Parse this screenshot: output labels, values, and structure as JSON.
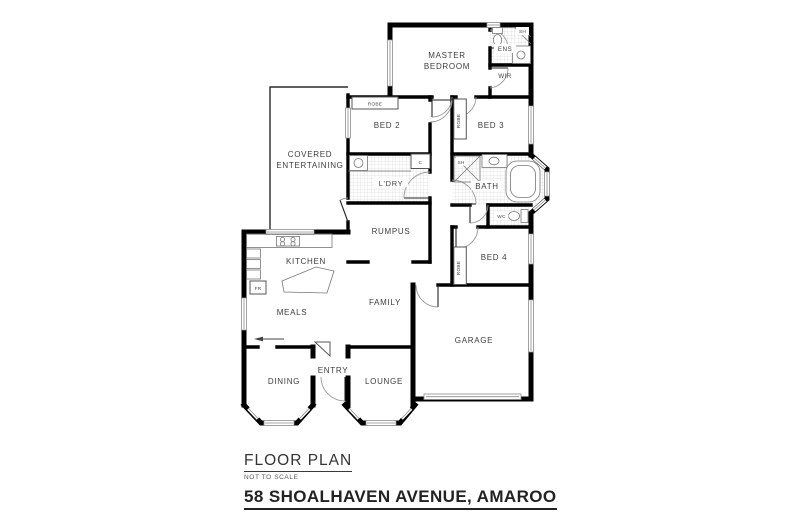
{
  "title_block": {
    "heading": "FLOOR PLAN",
    "note": "NOT TO SCALE",
    "address": "58 SHOALHAVEN AVENUE, AMAROO"
  },
  "colors": {
    "wall": "#000000",
    "label": "#3d3d3d",
    "tile_line": "#cfcfcf",
    "background": "#ffffff"
  },
  "rooms": {
    "master_line1": "MASTER",
    "master_line2": "BEDROOM",
    "ens": "ENS",
    "ens_shower": "SH",
    "wir": "WIR",
    "bed2": "BED 2",
    "bed2_robe": "ROBE",
    "bed3": "BED 3",
    "bed3_robe": "ROBE",
    "covered_line1": "COVERED",
    "covered_line2": "ENTERTAINING",
    "laundry": "L'DRY",
    "laundry_cupboard": "C",
    "bath": "BATH",
    "bath_shower": "SH",
    "wc": "WC",
    "rumpus": "RUMPUS",
    "bed4": "BED 4",
    "bed4_robe": "ROBE",
    "kitchen": "KITCHEN",
    "fridge": "FR",
    "meals": "MEALS",
    "family": "FAMILY",
    "garage": "GARAGE",
    "dining": "DINING",
    "entry": "ENTRY",
    "lounge": "LOUNGE"
  }
}
